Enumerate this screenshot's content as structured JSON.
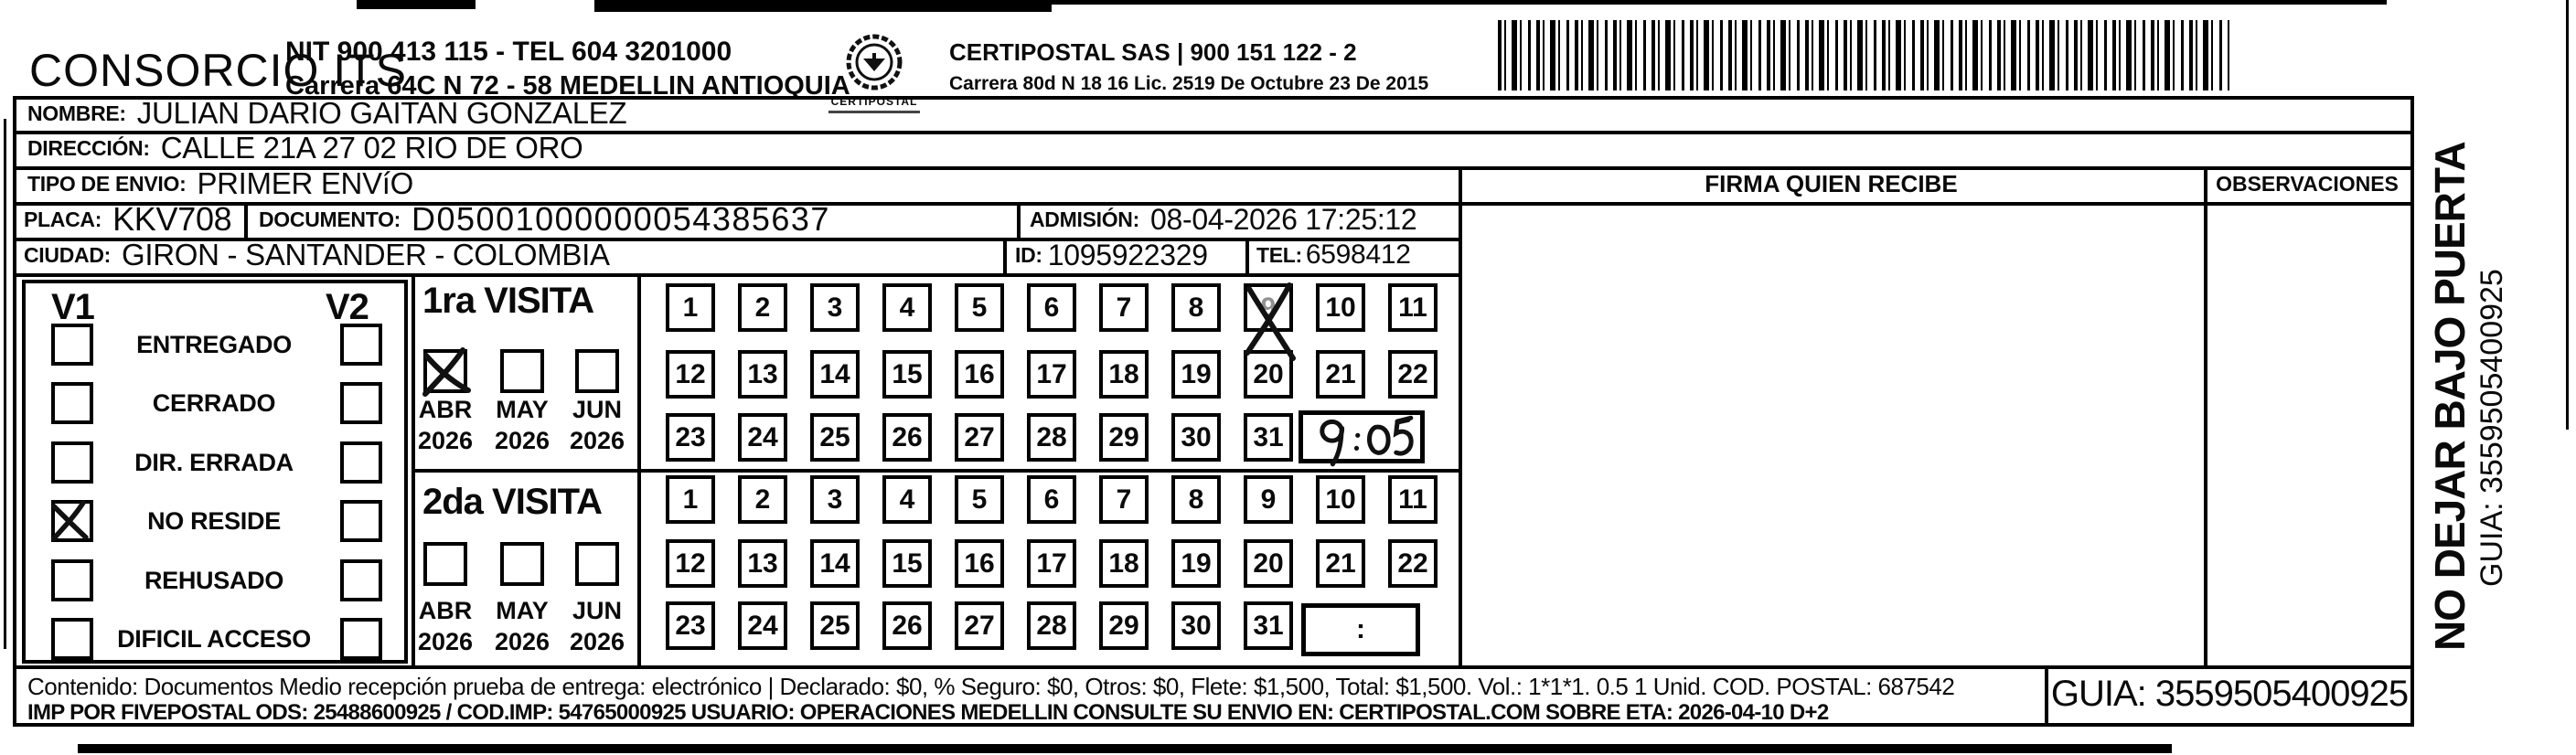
{
  "header": {
    "consorcio": "CONSORCIO ITS",
    "nit_line": "NIT 900 413 115 - TEL 604 3201000",
    "address_line": "Carrera 64C N 72 - 58 MEDELLIN ANTIOQUIA",
    "logo_caption": "CERTIPOSTAL",
    "certipostal_line": "CERTIPOSTAL SAS | 900 151 122 - 2",
    "certipostal_address": "Carrera 80d N 18 16  Lic. 2519 De Octubre 23 De 2015"
  },
  "fields": {
    "nombre_label": "NOMBRE:",
    "nombre": "JULIAN DARIO GAITAN GONZALEZ",
    "direccion_label": "DIRECCIÓN:",
    "direccion": "CALLE 21A 27 02 RIO DE ORO",
    "tipo_label": "TIPO DE ENVIO:",
    "tipo": "PRIMER ENVíO",
    "placa_label": "PLACA:",
    "placa": "KKV708",
    "documento_label": "DOCUMENTO:",
    "documento": "D05001000000054385637",
    "admision_label": "ADMISIÓN:",
    "admision": "08-04-2026 17:25:12",
    "ciudad_label": "CIUDAD:",
    "ciudad": "GIRON - SANTANDER - COLOMBIA",
    "id_label": "ID:",
    "id": "1095922329",
    "tel_label": "TEL:",
    "tel": "6598412"
  },
  "signature": {
    "firma_header": "FIRMA QUIEN RECIBE",
    "observaciones_header": "OBSERVACIONES"
  },
  "visits": {
    "v1_label": "V1",
    "v2_label": "V2",
    "statuses": [
      "ENTREGADO",
      "CERRADO",
      "DIR. ERRADA",
      "NO RESIDE",
      "REHUSADO",
      "DIFICIL ACCESO"
    ],
    "v1_checked_status": "NO RESIDE",
    "days_rows": [
      [
        1,
        2,
        3,
        4,
        5,
        6,
        7,
        8,
        9,
        10,
        11
      ],
      [
        12,
        13,
        14,
        15,
        16,
        17,
        18,
        19,
        20,
        21,
        22
      ],
      [
        23,
        24,
        25,
        26,
        27,
        28,
        29,
        30,
        31
      ]
    ],
    "first": {
      "title": "1ra VISITA",
      "months": [
        "ABR",
        "MAY",
        "JUN"
      ],
      "years": [
        "2026",
        "2026",
        "2026"
      ],
      "checked_month": "ABR",
      "marked_day": 9,
      "handwritten_time": "9:05"
    },
    "second": {
      "title": "2da VISITA",
      "months": [
        "ABR",
        "MAY",
        "JUN"
      ],
      "years": [
        "2026",
        "2026",
        "2026"
      ],
      "checked_month": null,
      "marked_day": null,
      "time_placeholder": ":"
    }
  },
  "side_note": {
    "line1": "NO DEJAR BAJO PUERTA",
    "line2": "GUIA: 3559505400925"
  },
  "footer": {
    "line1": "Contenido: Documentos Medio recepción prueba de entrega: electrónico | Declarado: $0, % Seguro: $0, Otros: $0, Flete: $1,500, Total: $1,500. Vol.: 1*1*1. 0.5 1 Unid. COD. POSTAL: 687542",
    "line2": "IMP POR FIVEPOSTAL ODS: 25488600925 / COD.IMP: 54765000925 USUARIO: OPERACIONES MEDELLIN CONSULTE SU ENVIO EN: CERTIPOSTAL.COM SOBRE ETA: 2026-04-10 D+2",
    "guia": "GUIA: 3559505400925"
  }
}
